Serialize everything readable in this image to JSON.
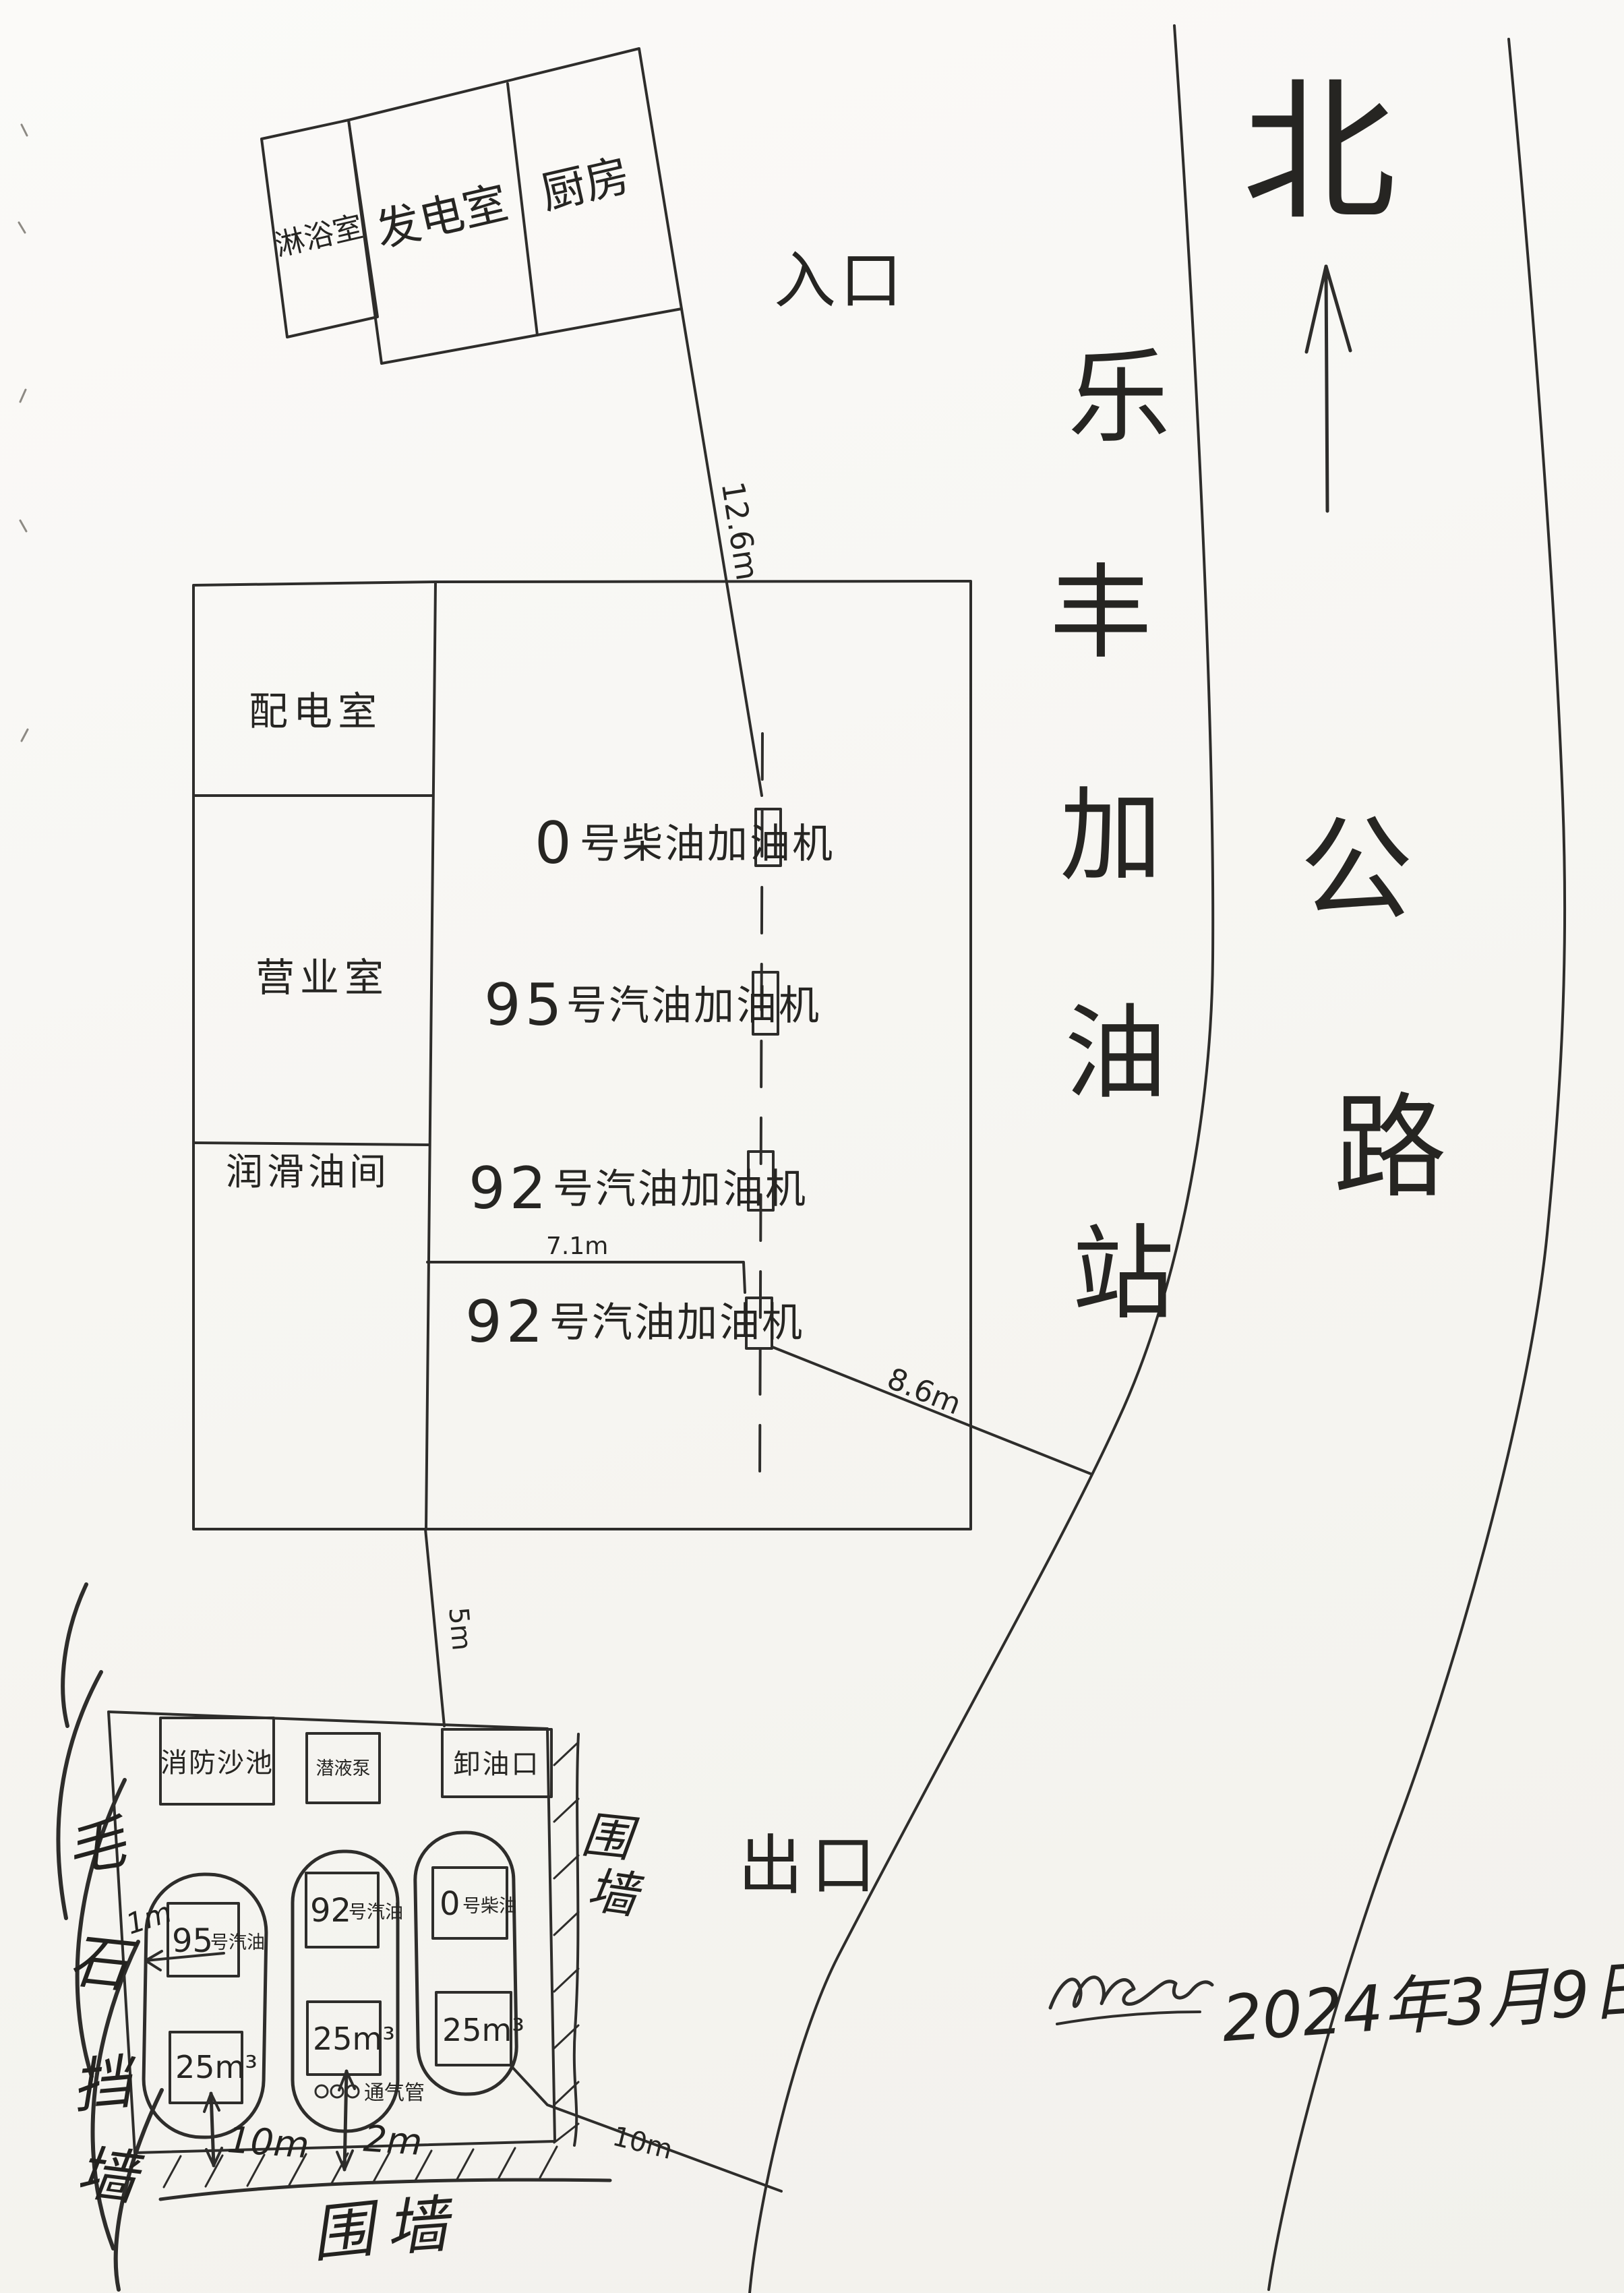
{
  "page": {
    "date": "2024年3月9日"
  },
  "compass": {
    "north": "北"
  },
  "labels": {
    "entrance": "入口",
    "exit": "出口"
  },
  "road": {
    "chars": [
      "公",
      "路"
    ]
  },
  "station_name_chars": [
    "乐",
    "丰",
    "加",
    "油",
    "站"
  ],
  "top_building": {
    "rooms": [
      {
        "name": "淋浴室"
      },
      {
        "name": "发电室"
      },
      {
        "name": "厨房"
      }
    ]
  },
  "main_building": {
    "rooms": [
      {
        "name": "配电室"
      },
      {
        "name": "营业室"
      },
      {
        "name": "润滑油间"
      }
    ]
  },
  "dispensers": [
    {
      "num": "0",
      "label": "号柴油加油机"
    },
    {
      "num": "95",
      "label": "号汽油加油机"
    },
    {
      "num": "92",
      "label": "号汽油加油机"
    },
    {
      "num": "92",
      "label": "号汽油加油机"
    }
  ],
  "dimensions": {
    "building_to_island": "12.6m",
    "room_to_island": "7.1m",
    "island_to_road": "8.6m",
    "station_to_tanks": "5m",
    "tank_pit_width": "10m",
    "vent_offset": "2m",
    "tank_to_wall": "1m",
    "tanks_to_road": "10m"
  },
  "tank_farm": {
    "fire_sand_pool": "消防沙池",
    "pump": "潜液泵",
    "unloading_port": "卸油口",
    "tanks": [
      {
        "num": "95",
        "grade": "号汽油",
        "volume": "25m³"
      },
      {
        "num": "92",
        "grade": "号汽油",
        "volume": "25m³"
      },
      {
        "num": "0",
        "grade": "号柴油",
        "volume": "25m³"
      }
    ],
    "vent_pipe": "通气管",
    "retaining_wall_chars": [
      "毛",
      "石",
      "挡",
      "墙"
    ],
    "wall_right_chars": [
      "围",
      "墙"
    ],
    "wall_bottom_chars": [
      "围",
      "墙"
    ]
  }
}
